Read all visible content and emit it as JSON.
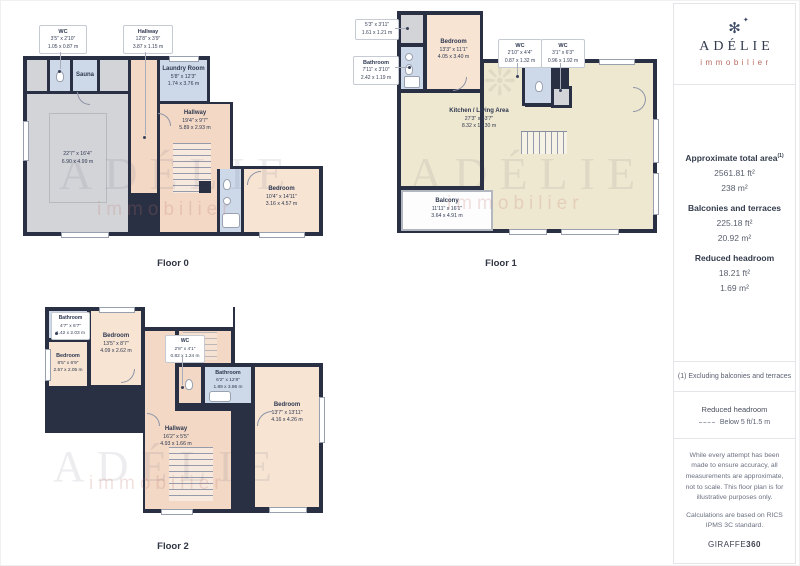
{
  "sidebar": {
    "brand": {
      "name": "ADÉLIE",
      "tagline": "immobilier"
    },
    "stats": {
      "total_label": "Approximate total area",
      "total_sup": "(1)",
      "total_ft": "2561.81 ft²",
      "total_m": "238 m²",
      "balconies_label": "Balconies and terraces",
      "balconies_ft": "225.18 ft²",
      "balconies_m": "20.92 m²",
      "reduced_label": "Reduced headroom",
      "reduced_ft": "18.21 ft²",
      "reduced_m": "1.69 m²"
    },
    "note": "(1) Excluding balconies and terraces",
    "legend": {
      "title": "Reduced headroom",
      "item": "Below 5 ft/1.5 m"
    },
    "disclaimer": "While every attempt has been made to ensure accuracy, all measurements are approximate, not to scale. This floor plan is for illustrative purposes only.",
    "standard": "Calculations are based on RICS IPMS 3C standard.",
    "credit": {
      "brand": "GIRAFFE",
      "suffix": "360"
    }
  },
  "icons": {
    "logo_star": "✻",
    "logo_sparkle": "✦",
    "plant": "❊"
  },
  "watermark": {
    "name": "ADÉLIE",
    "tagline": "immobilier"
  },
  "floors": [
    {
      "label": "Floor 0",
      "callouts": [
        {
          "name": "WC",
          "ft": "3'5\" x 2'10\"",
          "m": "1.05 x 0.87 m"
        },
        {
          "name": "Hallway",
          "ft": "12'8\" x 3'9\"",
          "m": "3.87 x 1.15 m"
        }
      ],
      "rooms": {
        "sauna": {
          "name": "Sauna"
        },
        "laundry": {
          "name": "Laundry Room",
          "ft": "5'8\" x 12'3\"",
          "m": "1.74 x 3.76 m"
        },
        "garage": {
          "ft": "22'7\" x 16'4\"",
          "m": "6.90 x 4.99 m"
        },
        "hallway": {
          "name": "Hallway",
          "ft": "19'4\" x 9'7\"",
          "m": "5.89 x 2.93 m"
        },
        "bedroom": {
          "name": "Bedroom",
          "ft": "10'4\" x 14'11\"",
          "m": "3.16 x 4.57 m"
        }
      }
    },
    {
      "label": "Floor 1",
      "callouts": [
        {
          "ft": "5'3\" x 3'11\"",
          "m": "1.61 x 1.21 m"
        },
        {
          "name": "Bathroom",
          "ft": "7'11\" x 3'10\"",
          "m": "2.42 x 1.19 m"
        },
        {
          "name": "WC",
          "ft": "2'10\" x 4'4\"",
          "m": "0.87 x 1.32 m"
        },
        {
          "name": "WC",
          "ft": "3'1\" x 6'3\"",
          "m": "0.96 x 1.92 m"
        }
      ],
      "rooms": {
        "bedroom": {
          "name": "Bedroom",
          "ft": "13'3\" x 11'1\"",
          "m": "4.05 x 3.40 m"
        },
        "kitchen": {
          "name": "Kitchen / Living Area",
          "ft": "27'3\" x 43'7\"",
          "m": "8.32 x 13.30 m"
        },
        "balcony": {
          "name": "Balcony",
          "ft": "11'11\" x 16'1\"",
          "m": "3.64 x 4.91 m"
        }
      }
    },
    {
      "label": "Floor 2",
      "callouts": [
        {
          "name": "Bathroom",
          "ft": "4'7\" x 6'7\"",
          "m": "1.42 x 2.03 m"
        },
        {
          "name": "WC",
          "ft": "2'8\" x 4'1\"",
          "m": "0.82 x 1.24 m"
        }
      ],
      "rooms": {
        "bedroom_top": {
          "name": "Bedroom",
          "ft": "13'5\" x 8'7\"",
          "m": "4.09 x 2.62 m"
        },
        "bedroom_left": {
          "name": "Bedroom",
          "ft": "8'5\" x 6'9\"",
          "m": "2.57 x 2.05 m"
        },
        "bathroom": {
          "name": "Bathroom",
          "ft": "6'2\" x 12'8\"",
          "m": "1.89 x 3.86 m"
        },
        "bedroom_right": {
          "name": "Bedroom",
          "ft": "13'7\" x 13'11\"",
          "m": "4.16 x 4.26 m"
        },
        "hallway": {
          "name": "Hallway",
          "ft": "16'2\" x 5'5\"",
          "m": "4.93 x 1.66 m"
        }
      }
    }
  ],
  "colors": {
    "wall": "#2a3044",
    "bedroom": "#f7e4d3",
    "hallway": "#f2d8c5",
    "kitchen": "#efe8d0",
    "wet_room": "#cdd9e9",
    "utility_gray": "#d3d4d8",
    "accent": "#b66a60"
  }
}
